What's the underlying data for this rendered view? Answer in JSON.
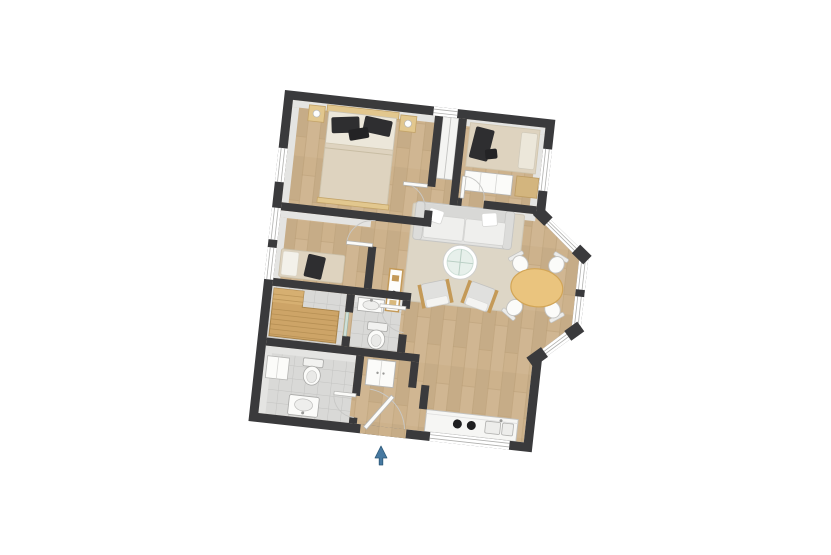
{
  "scene": {
    "kind": "Top-down 3D floor plan rendering of a two-bedroom apartment on a white background",
    "background": "#ffffff",
    "plan_rotation_deg": 6.3
  },
  "rooms": [
    {
      "name": "bedroom-1",
      "position": "top-left",
      "furniture": [
        "double bed with dark pillows and beige blanket",
        "two wood nightstands with lamps"
      ]
    },
    {
      "name": "bedroom-2",
      "position": "top-right",
      "furniture": [
        "single bed with beige bedding",
        "dark clothing item on bed",
        "white dresser",
        "wood side unit"
      ]
    },
    {
      "name": "living-room",
      "position": "center-right",
      "furniture": [
        "gray sofa with two white pillows",
        "round glass coffee table",
        "two armchairs with wood frames",
        "wood sideboard",
        "beige area rug"
      ]
    },
    {
      "name": "dining-bay",
      "position": "right",
      "furniture": [
        "oval wood dining table",
        "four white chairs"
      ],
      "feature": "angled bay windows"
    },
    {
      "name": "dressing-room",
      "position": "left-middle",
      "furniture": [
        "upholstered bench with dark garment"
      ]
    },
    {
      "name": "sauna",
      "position": "lower-left",
      "furniture": [
        "L-shaped tiered wood benches"
      ]
    },
    {
      "name": "bathroom-1",
      "position": "center-left",
      "furniture": [
        "wall sink",
        "toilet"
      ]
    },
    {
      "name": "bathroom-2",
      "position": "bottom-left",
      "furniture": [
        "white cabinet",
        "toilet",
        "vanity sink"
      ]
    },
    {
      "name": "entry-vestibule",
      "position": "bottom-center",
      "furniture": [
        "built-in closet"
      ]
    },
    {
      "name": "kitchen",
      "position": "bottom-right",
      "furniture": [
        "white counter",
        "cooktop with two burners",
        "double sink"
      ],
      "feature": "window band behind counter"
    }
  ],
  "openings": {
    "entrance": "bottom wall, center-left, door leaf shown",
    "windows": [
      "left wall x3",
      "top wall x1",
      "right wall x1",
      "bay window x3 segments",
      "kitchen window band"
    ]
  },
  "entrance_marker": {
    "shape": "arrow",
    "direction": "up toward entrance door",
    "color": "#4779a1"
  },
  "colors": {
    "wall": "#3a3a3c",
    "wall_face": "#e4e4e2",
    "wood_floor": "#cdb28c",
    "tile_floor": "#d9d9d7",
    "rug": "#ddd6c6",
    "sofa": "#e3e3e1",
    "sofa_cushion": "#efefed",
    "glass": "#e7f0eb",
    "armchair": "#e0e0de",
    "armchair_wood": "#c49a58",
    "dining_table": "#eac47e",
    "blanket": "#ded3bf",
    "mattress": "#ece7da",
    "pillow_dark": "#2e2e30",
    "nightstand": "#e2c78e",
    "sauna_bench": "#cda467",
    "fixture": "#fbfbf9",
    "fixture_stroke": "#a9a9a7",
    "counter": "#f6f6f4",
    "burner": "#1e1e20",
    "arrow": "#4779a1"
  }
}
